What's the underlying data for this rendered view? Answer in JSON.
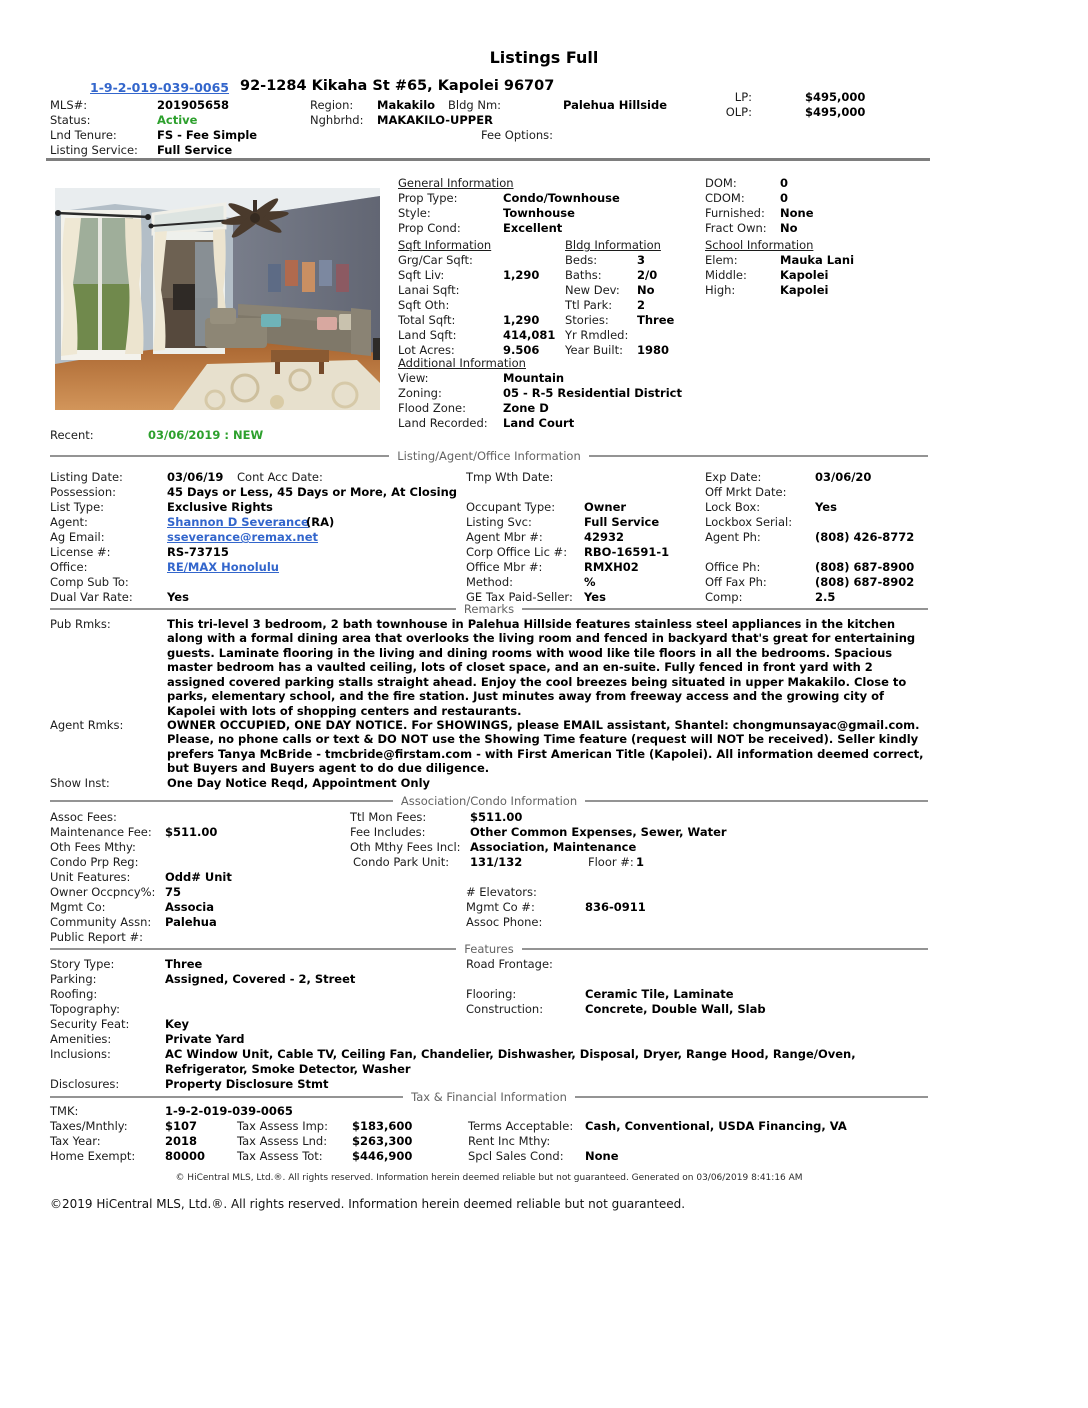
{
  "colors": {
    "active_green": "#2da02d",
    "link_blue": "#3366cc",
    "divider_gray": "#949494"
  },
  "title": "Listings Full",
  "hdr": {
    "tmk_link": "1-9-2-019-039-0065",
    "address": "92-1284 Kikaha St #65, Kapolei 96707",
    "mls_l": "MLS#:",
    "mls_v": "201905658",
    "region_l": "Region:",
    "region_v": "Makakilo",
    "bldg_l": "Bldg Nm:",
    "bldg_v": "Palehua Hillside",
    "status_l": "Status:",
    "status_v": "Active",
    "nghbrhd_l": "Nghbrhd:",
    "nghbrhd_v": "MAKAKILO-UPPER",
    "tenure_l": "Lnd Tenure:",
    "tenure_v": "FS - Fee Simple",
    "fee_opt_l": "Fee Options:",
    "lsvc_l": "Listing Service:",
    "lsvc_v": "Full Service",
    "lp_l": "LP:",
    "lp_v": "$495,000",
    "olp_l": "OLP:",
    "olp_v": "$495,000"
  },
  "photo": {
    "name": "living-room-photo"
  },
  "general": {
    "heading": "General Information",
    "prop_type_l": "Prop Type:",
    "prop_type_v": "Condo/Townhouse",
    "style_l": "Style:",
    "style_v": "Townhouse",
    "prop_cond_l": "Prop Cond:",
    "prop_cond_v": "Excellent"
  },
  "domblk": {
    "dom_l": "DOM:",
    "dom_v": "0",
    "cdom_l": "CDOM:",
    "cdom_v": "0",
    "furn_l": "Furnished:",
    "furn_v": "None",
    "fract_l": "Fract Own:",
    "fract_v": "No"
  },
  "sqft": {
    "heading": "Sqft Information",
    "grg_l": "Grg/Car Sqft:",
    "grg_v": "",
    "liv_l": "Sqft Liv:",
    "liv_v": "1,290",
    "lanai_l": "Lanai Sqft:",
    "lanai_v": "",
    "oth_l": "Sqft Oth:",
    "oth_v": "",
    "total_l": "Total Sqft:",
    "total_v": "1,290",
    "land_l": "Land Sqft:",
    "land_v": "414,081",
    "lot_l": "Lot Acres:",
    "lot_v": "9.506"
  },
  "bldg": {
    "heading": "Bldg Information",
    "beds_l": "Beds:",
    "beds_v": "3",
    "baths_l": "Baths:",
    "baths_v": "2/0",
    "newdev_l": "New Dev:",
    "newdev_v": "No",
    "park_l": "Ttl Park:",
    "park_v": "2",
    "stories_l": "Stories:",
    "stories_v": "Three",
    "rmdled_l": "Yr Rmdled:",
    "rmdled_v": "",
    "built_l": "Year Built:",
    "built_v": "1980"
  },
  "school": {
    "heading": "School Information",
    "elem_l": "Elem:",
    "elem_v": "Mauka Lani",
    "middle_l": "Middle:",
    "middle_v": "Kapolei",
    "high_l": "High:",
    "high_v": "Kapolei"
  },
  "additional": {
    "heading": "Additional Information",
    "view_l": "View:",
    "view_v": "Mountain",
    "zoning_l": "Zoning:",
    "zoning_v": "05 - R-5 Residential District",
    "flood_l": "Flood Zone:",
    "flood_v": "Zone D",
    "landrec_l": "Land Recorded:",
    "landrec_v": "Land Court"
  },
  "recent": {
    "l": "Recent:",
    "v": "03/06/2019 : NEW"
  },
  "li": {
    "section_title": "Listing/Agent/Office Information",
    "listing_date_l": "Listing Date:",
    "listing_date_v": "03/06/19",
    "cont_acc_l": "Cont Acc Date:",
    "tmp_wth_l": "Tmp Wth Date:",
    "exp_l": "Exp Date:",
    "exp_v": "03/06/20",
    "possession_l": "Possession:",
    "possession_v": "45 Days or Less, 45 Days or More, At Closing",
    "off_mrkt_l": "Off Mrkt Date:",
    "list_type_l": "List Type:",
    "list_type_v": "Exclusive Rights",
    "occupant_l": "Occupant Type:",
    "occupant_v": "Owner",
    "lockbox_l": "Lock Box:",
    "lockbox_v": "Yes",
    "agent_l": "Agent:",
    "agent_link": "Shannon D Severance",
    "agent_ra": "(RA)",
    "listing_svc_l": "Listing Svc:",
    "listing_svc_v": "Full Service",
    "lockbox_serial_l": "Lockbox Serial:",
    "ag_email_l": "Ag Email:",
    "ag_email_v": "sseverance@remax.net",
    "agent_mbr_l": "Agent Mbr #:",
    "agent_mbr_v": "42932",
    "agent_ph_l": "Agent Ph:",
    "agent_ph_v": "(808) 426-8772",
    "license_l": "License #:",
    "license_v": "RS-73715",
    "corp_lic_l": "Corp Office Lic #:",
    "corp_lic_v": "RBO-16591-1",
    "office_l": "Office:",
    "office_v": "RE/MAX Honolulu",
    "office_mbr_l": "Office Mbr #:",
    "office_mbr_v": "RMXH02",
    "office_ph_l": "Office Ph:",
    "office_ph_v": "(808) 687-8900",
    "comp_sub_l": "Comp Sub To:",
    "method_l": "Method:",
    "method_v": "%",
    "off_fax_l": "Off Fax Ph:",
    "off_fax_v": "(808) 687-8902",
    "dual_var_l": "Dual Var Rate:",
    "dual_var_v": "Yes",
    "ge_tax_l": "GE Tax Paid-Seller:",
    "ge_tax_v": "Yes",
    "comp_l": "Comp:",
    "comp_v": "2.5"
  },
  "remarks": {
    "section_title": "Remarks",
    "pub_l": "Pub Rmks:",
    "pub_lines": [
      "This tri-level 3 bedroom, 2 bath townhouse in Palehua Hillside features stainless steel appliances in the kitchen",
      "along with a formal dining area that overlooks the living room and fenced in backyard that's great for entertaining",
      "guests. Laminate flooring in the living and dining rooms with wood like tile floors in all the bedrooms. Spacious",
      "master bedroom has a vaulted ceiling, lots of closet space, and an en-suite. Fully fenced in front yard with 2",
      "assigned covered parking stalls straight ahead. Enjoy the cool breezes being situated in upper Makakilo. Close to",
      "parks, elementary school, and the fire station. Just minutes away from freeway access and the growing city of",
      "Kapolei with lots of shopping centers and restaurants."
    ],
    "agent_l": "Agent Rmks:",
    "agent_lines": [
      "OWNER OCCUPIED, ONE DAY NOTICE. For SHOWINGS, please EMAIL assistant, Shantel: chongmunsayac@gmail.com.",
      "Please, no phone calls or text & DO NOT use the Showing Time feature (request will NOT be received). Seller kindly",
      "prefers Tanya McBride - tmcbride@firstam.com - with First American Title (Kapolei). All information deemed correct,",
      "but Buyers and Buyers agent to do due diligence."
    ],
    "show_l": "Show Inst:",
    "show_v": "One Day Notice Reqd, Appointment Only"
  },
  "assoc": {
    "section_title": "Association/Condo Information",
    "assoc_fees_l": "Assoc Fees:",
    "ttl_mon_l": "Ttl Mon Fees:",
    "ttl_mon_v": "$511.00",
    "maint_l": "Maintenance Fee:",
    "maint_v": "$511.00",
    "fee_incl_l": "Fee Includes:",
    "fee_incl_v": "Other Common Expenses, Sewer, Water",
    "oth_fees_l": "Oth Fees Mthy:",
    "oth_mthy_l": "Oth Mthy Fees Incl:",
    "oth_mthy_v": "Association, Maintenance",
    "condo_prp_l": "Condo Prp Reg:",
    "condo_park_l": "Condo Park Unit:",
    "condo_park_v": "131/132",
    "floor_l": "Floor #:",
    "floor_v": "1",
    "unit_feat_l": "Unit Features:",
    "unit_feat_v": "Odd# Unit",
    "owner_occ_l": "Owner Occpncy%:",
    "owner_occ_v": "75",
    "elevators_l": "# Elevators:",
    "mgmt_co_l": "Mgmt Co:",
    "mgmt_co_v": "Associa",
    "mgmt_no_l": "Mgmt Co #:",
    "mgmt_no_v": "836-0911",
    "comm_assn_l": "Community Assn:",
    "comm_assn_v": "Palehua",
    "assoc_ph_l": "Assoc Phone:",
    "pub_report_l": "Public Report #:"
  },
  "features": {
    "section_title": "Features",
    "story_l": "Story Type:",
    "story_v": "Three",
    "road_l": "Road Frontage:",
    "parking_l": "Parking:",
    "parking_v": "Assigned, Covered - 2, Street",
    "roofing_l": "Roofing:",
    "flooring_l": "Flooring:",
    "flooring_v": "Ceramic Tile, Laminate",
    "topo_l": "Topography:",
    "constr_l": "Construction:",
    "constr_v": "Concrete, Double Wall, Slab",
    "security_l": "Security Feat:",
    "security_v": "Key",
    "amenities_l": "Amenities:",
    "amenities_v": "Private Yard",
    "incl_l": "Inclusions:",
    "incl_v1": "AC Window Unit, Cable TV, Ceiling Fan, Chandelier, Dishwasher, Disposal, Dryer, Range Hood, Range/Oven,",
    "incl_v2": "Refrigerator, Smoke Detector, Washer",
    "discl_l": "Disclosures:",
    "discl_v": "Property Disclosure Stmt"
  },
  "tax": {
    "section_title": "Tax & Financial Information",
    "tmk_l": "TMK:",
    "tmk_v": "1-9-2-019-039-0065",
    "taxes_l": "Taxes/Mnthly:",
    "taxes_v": "$107",
    "imp_l": "Tax Assess Imp:",
    "imp_v": "$183,600",
    "terms_l": "Terms Acceptable:",
    "terms_v": "Cash, Conventional, USDA Financing, VA",
    "tax_year_l": "Tax Year:",
    "tax_year_v": "2018",
    "lnd_l": "Tax Assess Lnd:",
    "lnd_v": "$263,300",
    "rent_l": "Rent Inc Mthy:",
    "home_ex_l": "Home Exempt:",
    "home_ex_v": "80000",
    "tot_l": "Tax Assess Tot:",
    "tot_v": "$446,900",
    "spcl_l": "Spcl Sales Cond:",
    "spcl_v": "None"
  },
  "footer": {
    "disclaimer": "© HiCentral MLS, Ltd.®. All rights reserved. Information herein deemed reliable but not guaranteed. Generated on 03/06/2019 8:41:16 AM",
    "copyright": "©2019 HiCentral MLS, Ltd.®. All rights reserved. Information herein deemed reliable but not guaranteed."
  }
}
